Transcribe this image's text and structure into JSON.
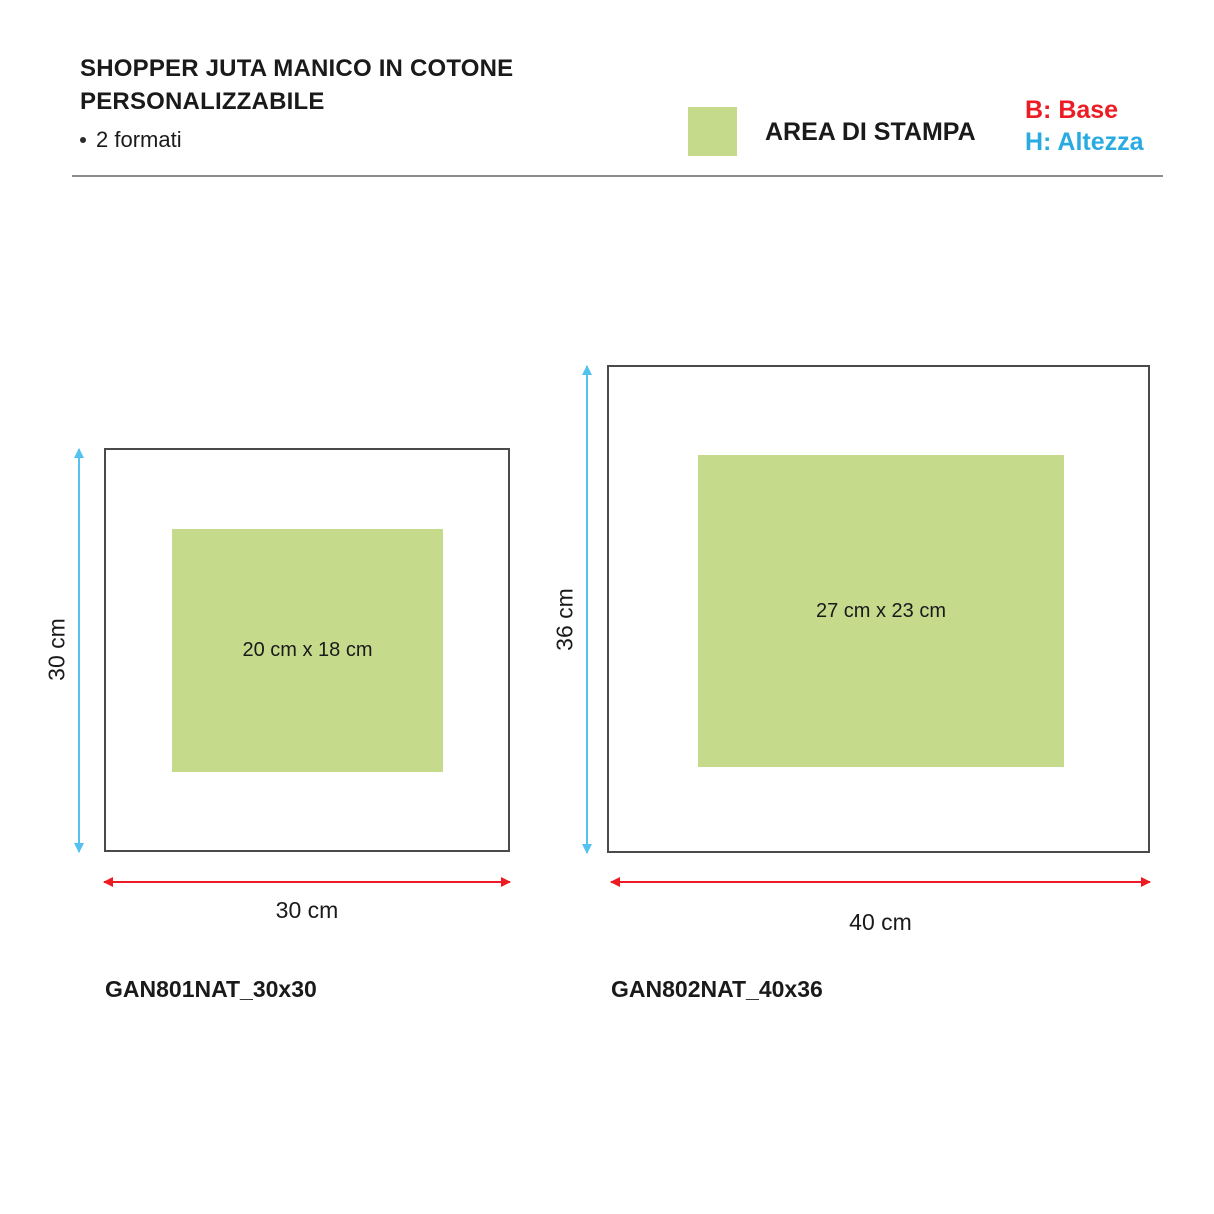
{
  "header": {
    "title_line1": "SHOPPER JUTA MANICO IN COTONE",
    "title_line2": "PERSONALIZZABILE",
    "bullet_item": "2 formati"
  },
  "legend": {
    "swatch_label": "AREA DI STAMPA",
    "base_label": "B: Base",
    "height_label": "H: Altezza"
  },
  "colors": {
    "print_area_green": "#c6da8c",
    "base_red": "#ed1c24",
    "height_blue": "#29abe2",
    "arrow_blue": "#54c2f0",
    "box_border_gray": "#4a4a4a"
  },
  "formats": [
    {
      "code": "GAN801NAT_30x30",
      "bag_width_label": "30 cm",
      "bag_height_label": "30 cm",
      "print_area_label": "20 cm x 18 cm"
    },
    {
      "code": "GAN802NAT_40x36",
      "bag_width_label": "40 cm",
      "bag_height_label": "36 cm",
      "print_area_label": "27 cm x 23 cm"
    }
  ]
}
